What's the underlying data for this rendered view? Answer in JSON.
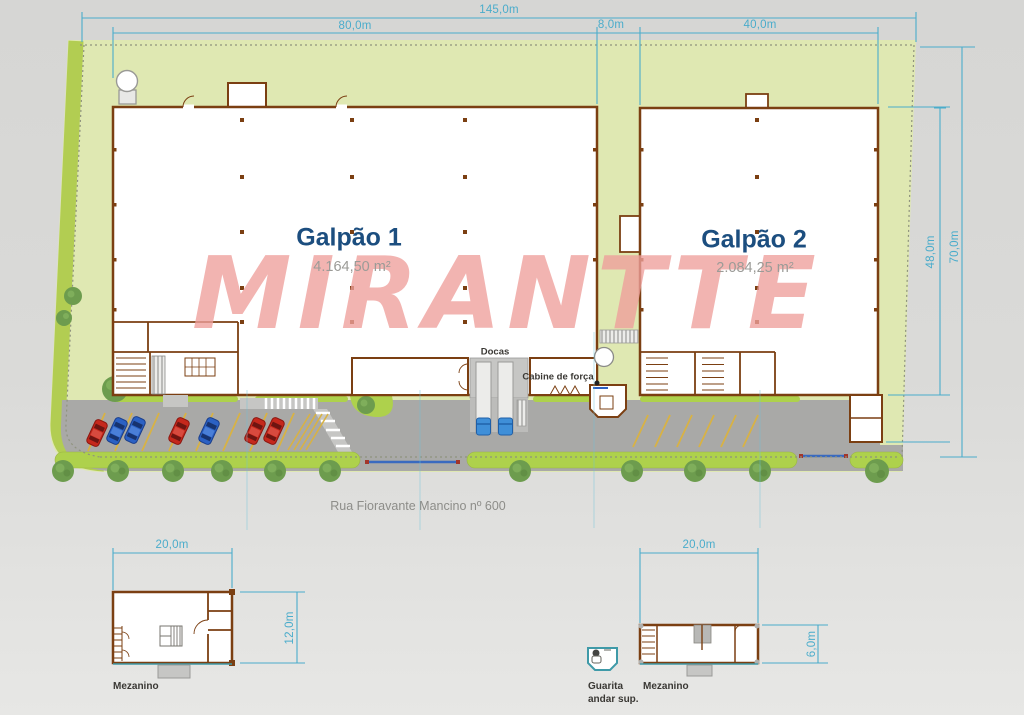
{
  "watermark": {
    "text": "MIRANTTE"
  },
  "site": {
    "street": "Rua Fioravante Mancino nº 600",
    "dimensions": {
      "total_width": "145,0m",
      "galpao1_width": "80,0m",
      "gap_width": "8,0m",
      "galpao2_width": "40,0m",
      "site_depth": "70,0m",
      "building_depth": "48,0m"
    }
  },
  "buildings": [
    {
      "id": "galpao1",
      "name": "Galpão 1",
      "area": "4.164,50 m²"
    },
    {
      "id": "galpao2",
      "name": "Galpão 2",
      "area": "2.084,25 m²"
    }
  ],
  "plan_labels": {
    "docas": "Docas",
    "cabine_de_forca": "Cabine de força"
  },
  "mezzanines": {
    "left": {
      "label": "Mezanino",
      "width": "20,0m",
      "depth": "12,0m"
    },
    "right": {
      "label": "Mezanino",
      "width": "20,0m",
      "depth": "6,0m"
    }
  },
  "guarita": {
    "line1": "Guarita",
    "line2": "andar sup."
  },
  "colors": {
    "site_green": "#dfe8b2",
    "edge_green": "#aed14c",
    "tree_green": "#6d9c4e",
    "wall_brown": "#7b3f12",
    "road_gray": "#a9a9a7",
    "dimension_cyan": "#4aaccb",
    "label_navy": "#1c4e7f",
    "watermark_pink": "#ef9f9c",
    "car_red": "#c5281c",
    "car_blue": "#2b61c4",
    "stripe_yellow": "#d8b244",
    "gate_blue": "#3a6abf"
  }
}
